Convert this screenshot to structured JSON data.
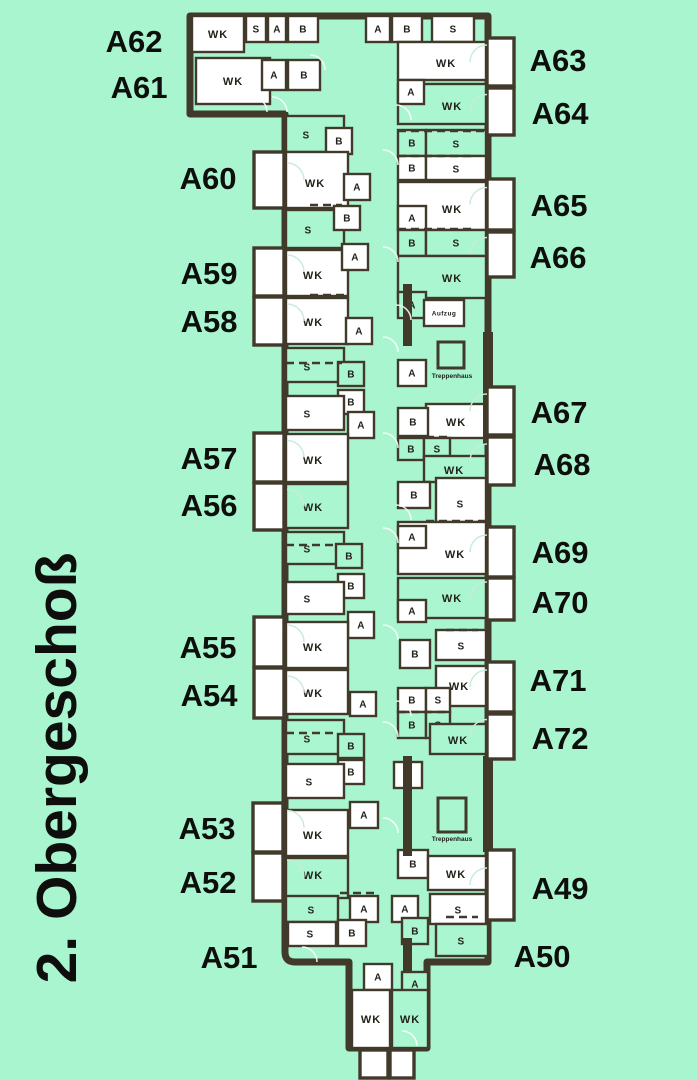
{
  "title": {
    "text": "2. Obergeschoß"
  },
  "colors": {
    "background": "#a8f5cf",
    "wall": "#413a2b",
    "room_white": "#ffffff",
    "room_green": "#aaf6d1",
    "label_text": "#22211a",
    "apartment_text": "#0e0e0c",
    "arc": "#ffffff",
    "balcony_fill": "#ffffff"
  },
  "apartments": {
    "left": [
      {
        "label": "A62",
        "x": 134,
        "y": 41
      },
      {
        "label": "A61",
        "x": 139,
        "y": 87
      },
      {
        "label": "A60",
        "x": 208,
        "y": 178
      },
      {
        "label": "A59",
        "x": 209,
        "y": 273
      },
      {
        "label": "A58",
        "x": 209,
        "y": 321
      },
      {
        "label": "A57",
        "x": 209,
        "y": 458
      },
      {
        "label": "A56",
        "x": 209,
        "y": 505
      },
      {
        "label": "A55",
        "x": 208,
        "y": 647
      },
      {
        "label": "A54",
        "x": 209,
        "y": 695
      },
      {
        "label": "A53",
        "x": 207,
        "y": 828
      },
      {
        "label": "A52",
        "x": 208,
        "y": 882
      },
      {
        "label": "A51",
        "x": 229,
        "y": 957
      }
    ],
    "right": [
      {
        "label": "A63",
        "x": 558,
        "y": 60
      },
      {
        "label": "A64",
        "x": 560,
        "y": 113
      },
      {
        "label": "A65",
        "x": 559,
        "y": 205
      },
      {
        "label": "A66",
        "x": 558,
        "y": 257
      },
      {
        "label": "A67",
        "x": 559,
        "y": 412
      },
      {
        "label": "A68",
        "x": 562,
        "y": 464
      },
      {
        "label": "A69",
        "x": 560,
        "y": 552
      },
      {
        "label": "A70",
        "x": 560,
        "y": 602
      },
      {
        "label": "A71",
        "x": 558,
        "y": 680
      },
      {
        "label": "A72",
        "x": 560,
        "y": 738
      },
      {
        "label": "A49",
        "x": 560,
        "y": 888
      },
      {
        "label": "A50",
        "x": 542,
        "y": 956
      }
    ]
  },
  "rooms": [
    [
      "WK",
      192,
      16,
      52,
      36,
      "w"
    ],
    [
      "S",
      246,
      16,
      20,
      26,
      "w"
    ],
    [
      "A",
      268,
      16,
      18,
      26,
      "w"
    ],
    [
      "B",
      288,
      16,
      30,
      26,
      "w"
    ],
    [
      "WK",
      196,
      58,
      74,
      46,
      "w"
    ],
    [
      "A",
      262,
      60,
      24,
      30,
      "w"
    ],
    [
      "B",
      288,
      60,
      32,
      30,
      "w"
    ],
    [
      "A",
      366,
      16,
      24,
      26,
      "w"
    ],
    [
      "B",
      392,
      16,
      30,
      26,
      "w"
    ],
    [
      "S",
      432,
      16,
      42,
      26,
      "w"
    ],
    [
      "WK",
      398,
      42,
      88,
      38,
      "w",
      446,
      63
    ],
    [
      "WK",
      398,
      84,
      88,
      40,
      "g",
      452,
      106
    ],
    [
      "A",
      398,
      80,
      26,
      24,
      "w"
    ],
    [
      "B",
      398,
      130,
      28,
      26,
      "g"
    ],
    [
      "S",
      426,
      130,
      60,
      26,
      "g",
      456,
      144
    ],
    [
      "B",
      398,
      156,
      28,
      24,
      "w"
    ],
    [
      "S",
      426,
      156,
      60,
      24,
      "w",
      456,
      169
    ],
    [
      "WK",
      398,
      182,
      88,
      48,
      "w",
      452,
      209
    ],
    [
      "A",
      398,
      206,
      28,
      24,
      "w"
    ],
    [
      "B",
      398,
      230,
      28,
      26,
      "g"
    ],
    [
      "S",
      426,
      230,
      60,
      26,
      "g",
      456,
      243
    ],
    [
      "WK",
      398,
      256,
      88,
      42,
      "g",
      452,
      278
    ],
    [
      "A",
      398,
      292,
      28,
      26,
      "g"
    ],
    [
      "Aufzug",
      424,
      300,
      40,
      26,
      "w"
    ],
    [
      "A",
      398,
      360,
      28,
      26,
      "w"
    ],
    [
      "WK",
      426,
      404,
      60,
      34,
      "w",
      456,
      422
    ],
    [
      "B",
      398,
      408,
      30,
      28,
      "w"
    ],
    [
      "B",
      398,
      438,
      26,
      22,
      "g"
    ],
    [
      "S",
      424,
      438,
      26,
      22,
      "g"
    ],
    [
      "WK",
      424,
      456,
      62,
      26,
      "g",
      454,
      470
    ],
    [
      "S",
      436,
      478,
      50,
      44,
      "w",
      460,
      504
    ],
    [
      "B",
      398,
      482,
      32,
      26,
      "w"
    ],
    [
      "WK",
      398,
      522,
      88,
      52,
      "w",
      455,
      554
    ],
    [
      "A",
      398,
      526,
      28,
      22,
      "w"
    ],
    [
      "WK",
      398,
      578,
      88,
      40,
      "g",
      452,
      598
    ],
    [
      "A",
      398,
      600,
      28,
      22,
      "w"
    ],
    [
      "S",
      436,
      630,
      50,
      30,
      "w",
      461,
      646
    ],
    [
      "B",
      400,
      640,
      30,
      28,
      "w"
    ],
    [
      "WK",
      436,
      666,
      50,
      40,
      "w",
      459,
      686
    ],
    [
      "B",
      398,
      688,
      28,
      24,
      "w"
    ],
    [
      "S",
      426,
      688,
      24,
      24,
      "w"
    ],
    [
      "B",
      398,
      712,
      28,
      26,
      "g"
    ],
    [
      "S",
      426,
      712,
      24,
      26,
      "g"
    ],
    [
      "WK",
      430,
      724,
      56,
      30,
      "g",
      458,
      740
    ],
    [
      "A",
      394,
      762,
      28,
      26,
      "w"
    ],
    [
      "B",
      398,
      850,
      30,
      28,
      "w"
    ],
    [
      "WK",
      428,
      856,
      58,
      34,
      "w",
      456,
      874
    ],
    [
      "A",
      392,
      896,
      26,
      26,
      "w"
    ],
    [
      "S",
      430,
      894,
      56,
      30,
      "w",
      458,
      910
    ],
    [
      "B",
      402,
      918,
      26,
      26,
      "g"
    ],
    [
      "S",
      436,
      924,
      52,
      32,
      "g",
      461,
      941
    ],
    [
      "A",
      364,
      964,
      28,
      26,
      "w"
    ],
    [
      "A",
      402,
      972,
      26,
      24,
      "g"
    ],
    [
      "WK",
      352,
      990,
      38,
      58,
      "w"
    ],
    [
      "WK",
      392,
      990,
      36,
      58,
      "g"
    ],
    [
      "S",
      286,
      116,
      58,
      36,
      "g",
      306,
      135
    ],
    [
      "B",
      326,
      128,
      26,
      26,
      "w"
    ],
    [
      "WK",
      286,
      152,
      62,
      56,
      "w",
      315,
      183
    ],
    [
      "A",
      344,
      174,
      26,
      26,
      "w"
    ],
    [
      "S",
      286,
      210,
      58,
      38,
      "g",
      308,
      230
    ],
    [
      "B",
      334,
      206,
      26,
      24,
      "w"
    ],
    [
      "WK",
      286,
      250,
      62,
      46,
      "w",
      313,
      275
    ],
    [
      "A",
      342,
      244,
      26,
      26,
      "w"
    ],
    [
      "WK",
      286,
      298,
      62,
      46,
      "w",
      313,
      322
    ],
    [
      "A",
      346,
      318,
      26,
      26,
      "w"
    ],
    [
      "S",
      286,
      348,
      58,
      34,
      "g",
      307,
      367
    ],
    [
      "B",
      338,
      362,
      26,
      24,
      "g"
    ],
    [
      "B",
      338,
      390,
      26,
      24,
      "w"
    ],
    [
      "S",
      286,
      396,
      58,
      34,
      "w",
      307,
      414
    ],
    [
      "A",
      348,
      412,
      26,
      26,
      "w"
    ],
    [
      "WK",
      286,
      434,
      62,
      48,
      "w",
      313,
      460
    ],
    [
      "WK",
      286,
      484,
      62,
      44,
      "g",
      313,
      507
    ],
    [
      "S",
      286,
      532,
      58,
      32,
      "g",
      307,
      549
    ],
    [
      "B",
      336,
      544,
      26,
      24,
      "g"
    ],
    [
      "B",
      338,
      574,
      26,
      24,
      "w"
    ],
    [
      "S",
      286,
      582,
      58,
      32,
      "w",
      307,
      599
    ],
    [
      "A",
      348,
      612,
      26,
      26,
      "w"
    ],
    [
      "WK",
      286,
      622,
      62,
      46,
      "w",
      313,
      647
    ],
    [
      "WK",
      286,
      670,
      62,
      44,
      "w",
      313,
      693
    ],
    [
      "A",
      350,
      692,
      26,
      24,
      "w"
    ],
    [
      "S",
      286,
      720,
      58,
      34,
      "g",
      307,
      739
    ],
    [
      "B",
      338,
      734,
      26,
      24,
      "g"
    ],
    [
      "B",
      338,
      760,
      26,
      24,
      "w"
    ],
    [
      "S",
      286,
      764,
      58,
      34,
      "w",
      309,
      782
    ],
    [
      "A",
      350,
      802,
      28,
      26,
      "w"
    ],
    [
      "WK",
      286,
      810,
      62,
      46,
      "w",
      313,
      835
    ],
    [
      "WK",
      286,
      858,
      62,
      40,
      "g",
      313,
      875
    ],
    [
      "S",
      286,
      896,
      52,
      26,
      "g",
      311,
      910
    ],
    [
      "A",
      350,
      896,
      28,
      26,
      "w"
    ],
    [
      "S",
      288,
      922,
      48,
      24,
      "w",
      310,
      934
    ],
    [
      "B",
      338,
      920,
      28,
      26,
      "w"
    ]
  ],
  "stairwells": [
    {
      "label": "Treppenhaus",
      "box": [
        438,
        342,
        26,
        26
      ],
      "tx": 452,
      "ty": 378
    },
    {
      "label": "Treppenhaus",
      "box": [
        438,
        798,
        28,
        34
      ],
      "tx": 452,
      "ty": 841
    }
  ],
  "balconies": [
    [
      254,
      152,
      30,
      56
    ],
    [
      254,
      248,
      30,
      48
    ],
    [
      254,
      297,
      30,
      48
    ],
    [
      254,
      433,
      30,
      49
    ],
    [
      254,
      483,
      30,
      47
    ],
    [
      254,
      617,
      30,
      50
    ],
    [
      254,
      668,
      30,
      50
    ],
    [
      253,
      803,
      30,
      49
    ],
    [
      253,
      853,
      30,
      48
    ],
    [
      487,
      38,
      27,
      48
    ],
    [
      487,
      88,
      27,
      47
    ],
    [
      487,
      179,
      27,
      51
    ],
    [
      487,
      232,
      27,
      45
    ],
    [
      487,
      387,
      27,
      48
    ],
    [
      487,
      437,
      27,
      48
    ],
    [
      487,
      527,
      27,
      50
    ],
    [
      487,
      578,
      27,
      42
    ],
    [
      487,
      662,
      27,
      50
    ],
    [
      487,
      714,
      27,
      45
    ],
    [
      487,
      850,
      27,
      70
    ],
    [
      360,
      1050,
      28,
      28
    ],
    [
      390,
      1050,
      24,
      28
    ]
  ],
  "thick_walls": [
    [
      403,
      284,
      9,
      62
    ],
    [
      483,
      332,
      10,
      112
    ],
    [
      403,
      756,
      9,
      100
    ],
    [
      483,
      756,
      10,
      96
    ],
    [
      403,
      938,
      9,
      34
    ]
  ],
  "dashed_walls": [
    [
      398,
      131,
      486,
      131
    ],
    [
      398,
      156,
      474,
      156
    ],
    [
      398,
      229,
      474,
      229
    ],
    [
      426,
      437,
      450,
      437
    ],
    [
      446,
      630,
      478,
      630
    ],
    [
      398,
      712,
      446,
      712
    ],
    [
      286,
      363,
      342,
      363
    ],
    [
      286,
      545,
      336,
      545
    ],
    [
      286,
      733,
      338,
      733
    ],
    [
      340,
      893,
      378,
      893
    ],
    [
      446,
      917,
      478,
      917
    ],
    [
      310,
      205,
      342,
      205
    ],
    [
      426,
      521,
      486,
      521
    ],
    [
      310,
      295,
      346,
      295
    ]
  ],
  "door_arcs": [
    [
      383,
      165
    ],
    [
      383,
      262
    ],
    [
      383,
      352
    ],
    [
      383,
      448
    ],
    [
      383,
      543
    ],
    [
      383,
      640
    ],
    [
      383,
      737
    ],
    [
      383,
      833
    ],
    [
      396,
      120
    ],
    [
      396,
      320
    ],
    [
      396,
      520
    ],
    [
      396,
      716
    ],
    [
      302,
      962
    ],
    [
      366,
      1046
    ],
    [
      402,
      1046
    ],
    [
      252,
      112
    ],
    [
      272,
      112
    ],
    [
      310,
      70
    ]
  ]
}
